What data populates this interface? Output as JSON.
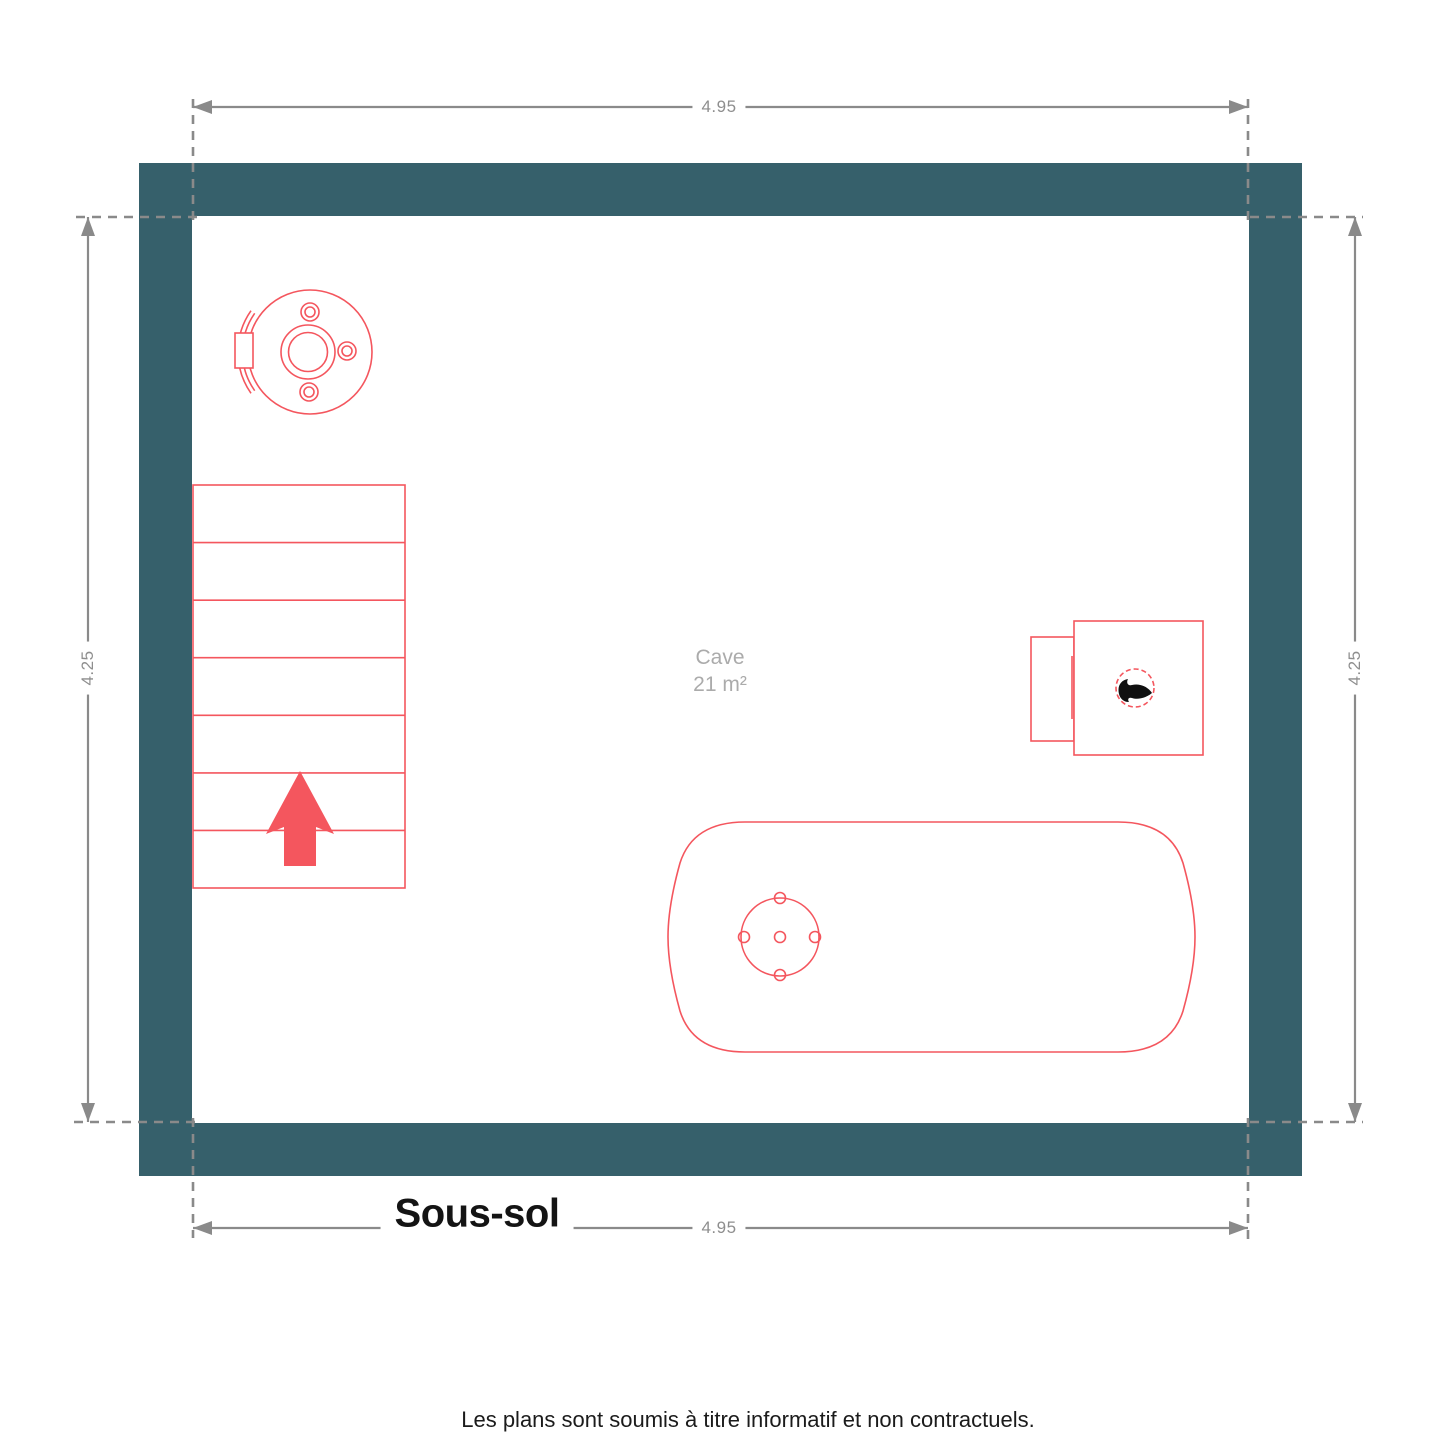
{
  "page": {
    "floor_title": "Sous-sol",
    "disclaimer": "Les plans sont soumis à titre informatif et non contractuels."
  },
  "room": {
    "name": "Cave",
    "area": "21 m²"
  },
  "dimensions": {
    "top": "4.95",
    "bottom": "4.95",
    "left": "4.25",
    "right": "4.25"
  },
  "colors": {
    "wall": "#36606B",
    "furniture": "#F4565E",
    "dimension_line": "#8A8A8A",
    "dimension_text": "#8E8E8E",
    "room_label": "#ABABAB",
    "title_text": "#141414"
  },
  "icons": {
    "flame": "flame-icon",
    "stairs_direction": "arrow-up-icon"
  },
  "furniture": [
    {
      "name": "boiler-tank-top-view",
      "location": "top-left"
    },
    {
      "name": "staircase-up",
      "location": "left",
      "steps": 7
    },
    {
      "name": "furnace-with-flame",
      "location": "right"
    },
    {
      "name": "horizontal-water-tank",
      "location": "bottom-center"
    }
  ]
}
